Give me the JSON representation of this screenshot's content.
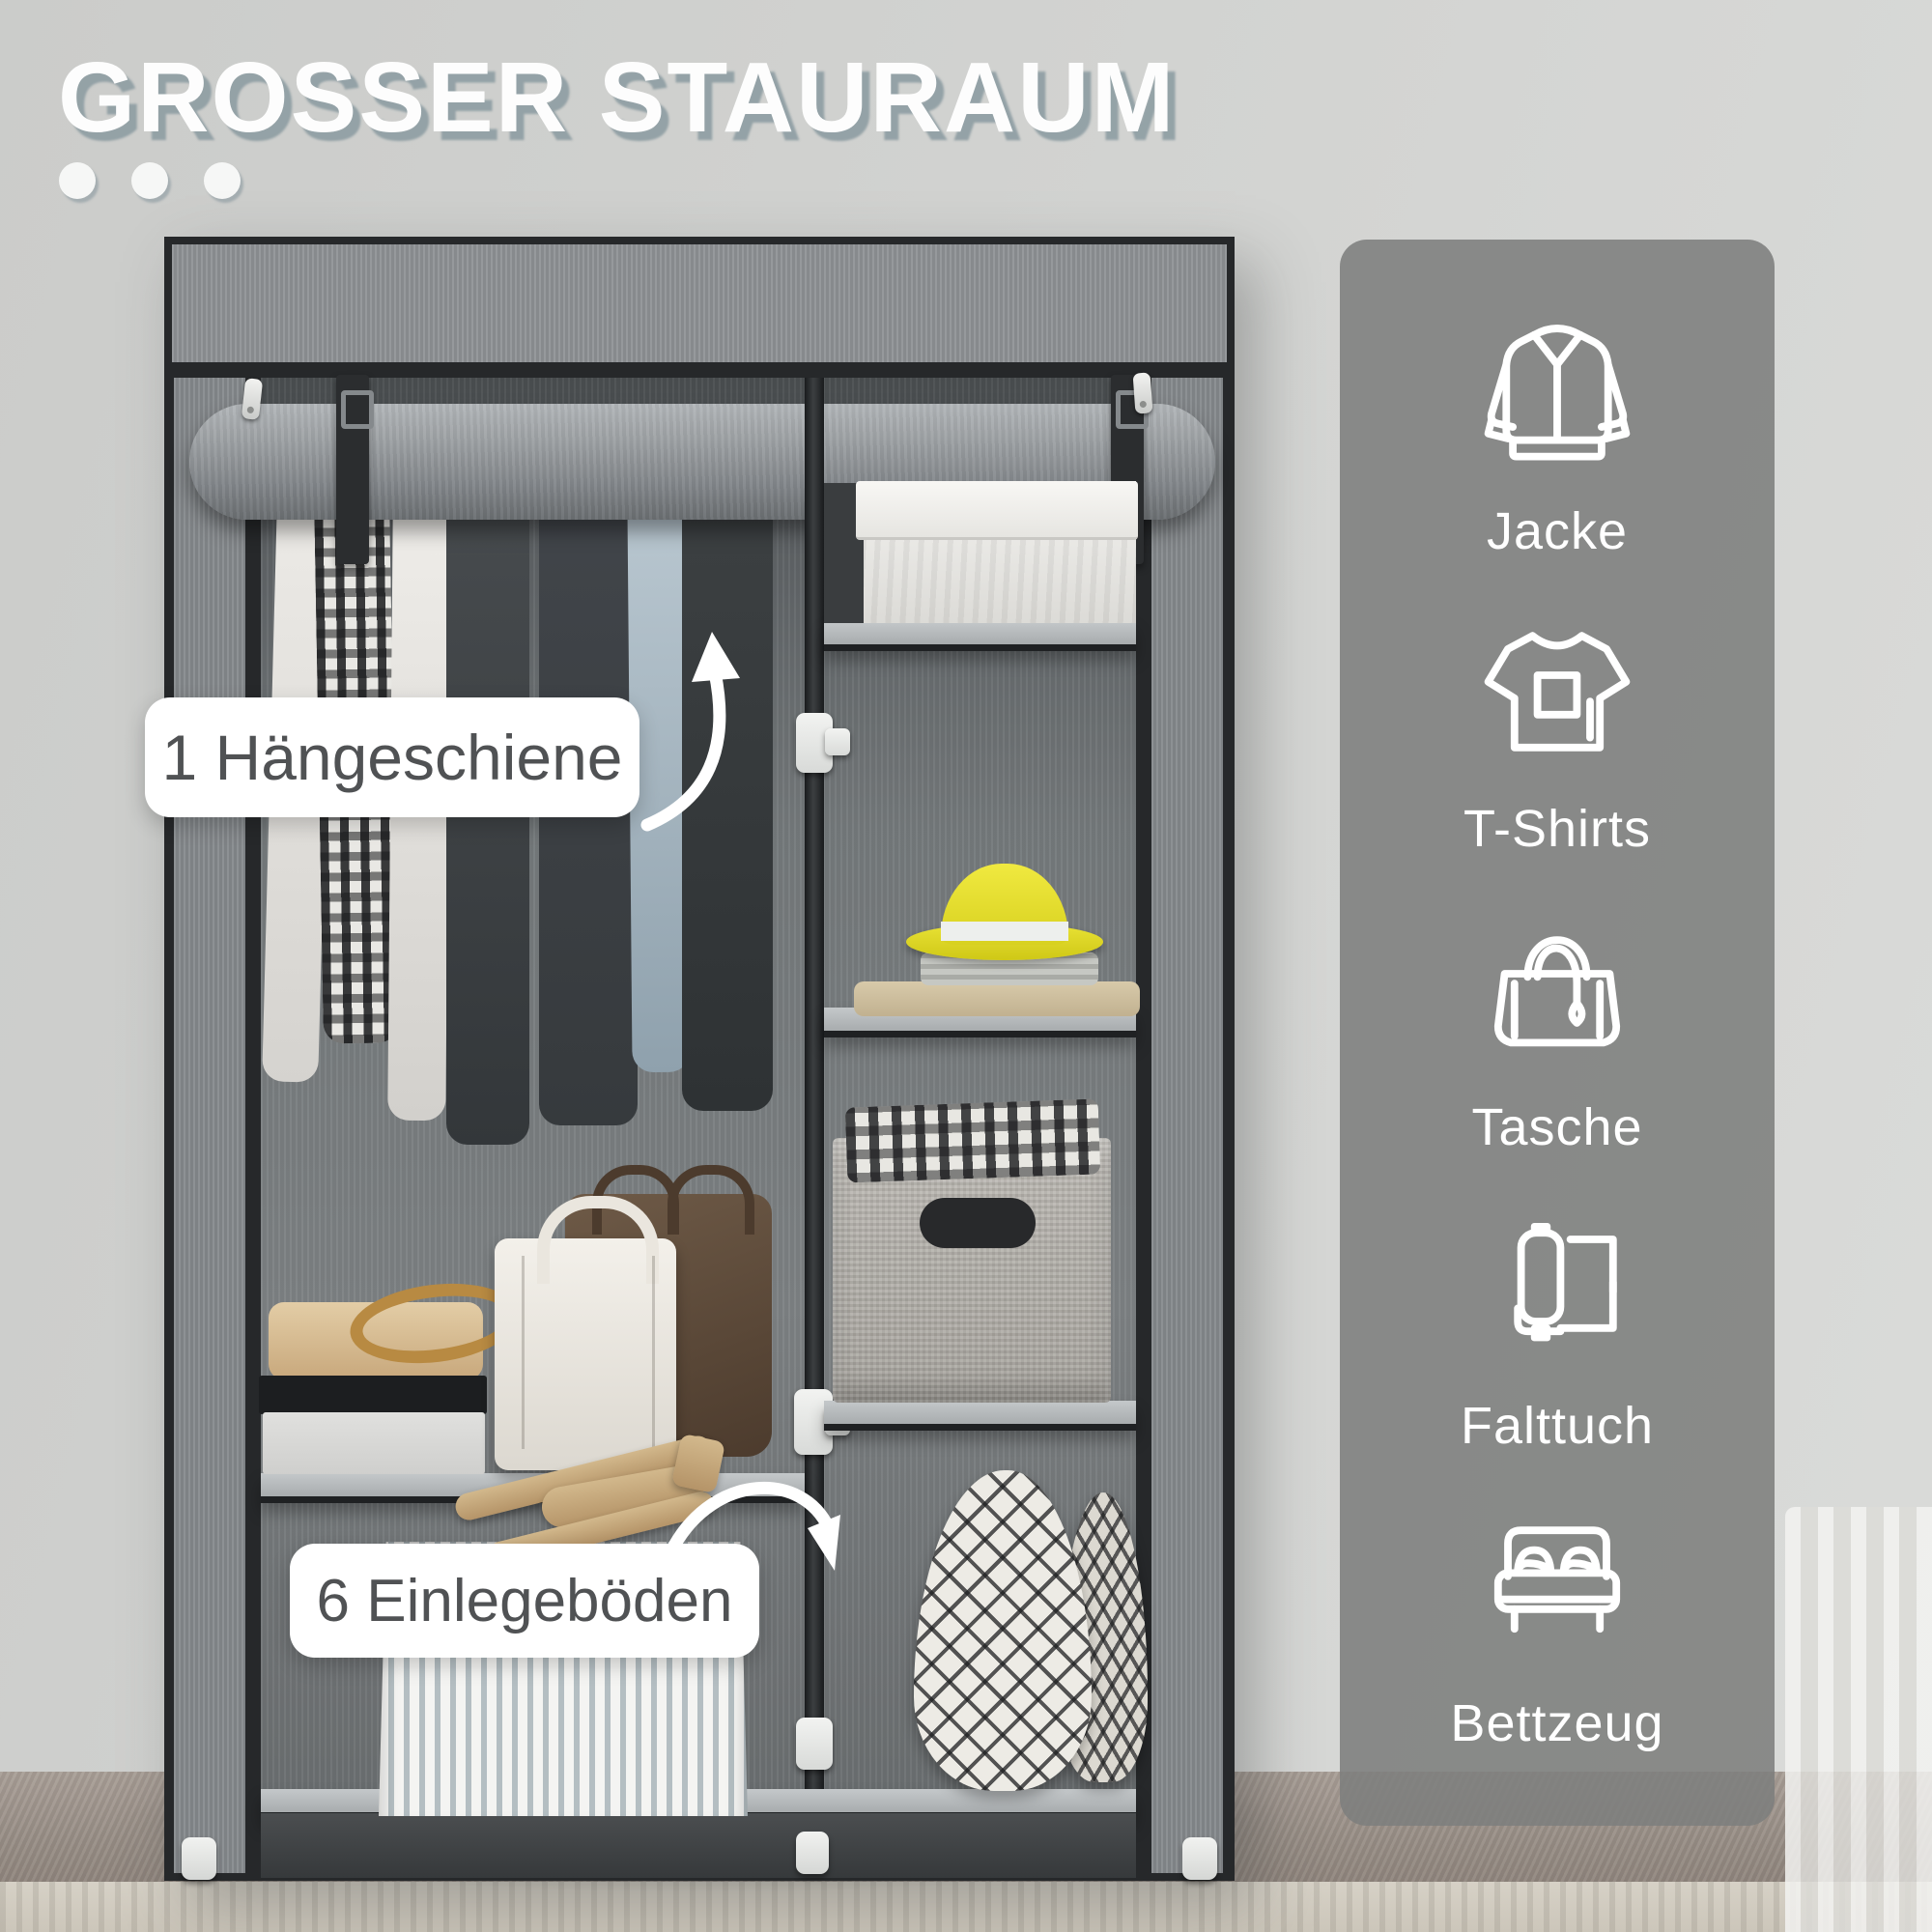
{
  "title": {
    "text": "GROSSER STAURAUM"
  },
  "callouts": {
    "hanging_rail": {
      "text": "1 Hängeschiene"
    },
    "shelves": {
      "text": "6 Einlegeböden"
    }
  },
  "sidebar": {
    "items": [
      {
        "icon": "jacket-icon",
        "label": "Jacke"
      },
      {
        "icon": "tshirt-icon",
        "label": "T-Shirts"
      },
      {
        "icon": "bag-icon",
        "label": "Tasche"
      },
      {
        "icon": "folded-cloth-icon",
        "label": "Falttuch"
      },
      {
        "icon": "bed-icon",
        "label": "Bettzeug"
      }
    ]
  },
  "colors": {
    "title_text": "#fdfdfd",
    "title_shadow": "#8a9aa0",
    "wall": "#d3d4d2",
    "wardrobe_fabric": "#8f9396",
    "wardrobe_frame": "#26282a",
    "sidebar_panel": "#7d7e7d",
    "callout_bg": "#ffffff",
    "callout_text": "#505254",
    "hat_yellow": "#e3dd2b"
  }
}
